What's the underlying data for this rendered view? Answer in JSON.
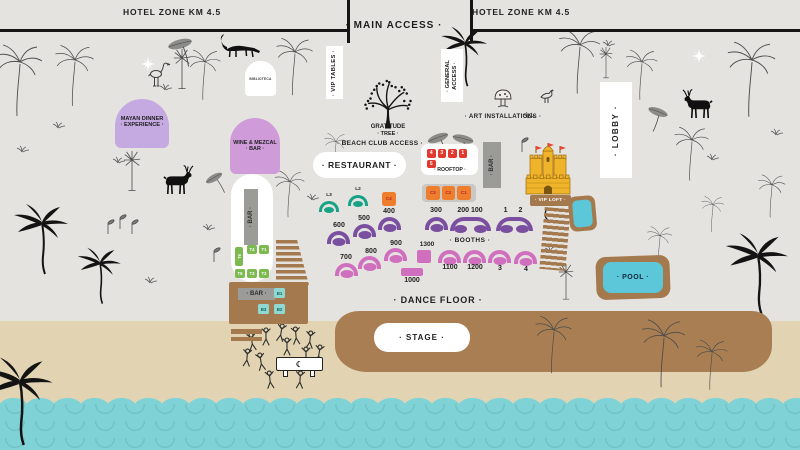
{
  "colors": {
    "background": "#e5e3e0",
    "sand": "#e2d4b2",
    "water": "#7fd2d5",
    "stage_brown": "#a87e52",
    "structure_brown": "#a5794e",
    "purple": "#7b4fa0",
    "pink": "#cf6fbe",
    "teal": "#16a285",
    "table_green": "#7cb94e",
    "cabana_orange": "#ee7e2e",
    "unit_red": "#e2382e",
    "castle_gold": "#f0b42a",
    "lavender": "#c5aae2",
    "orchid": "#cf9cd9",
    "label_gray": "#9b9b98",
    "pool_blue": "#5bc7d8",
    "seat_teal": "#8fd8d2",
    "line_black": "#151515"
  },
  "header": {
    "hotel_zone_left": "HOTEL ZONE KM 4.5",
    "main_access": "· MAIN ACCESS ·",
    "hotel_zone_right": "HOTEL ZONE KM 4.5"
  },
  "access": {
    "vip_tables": "· VIP TABLES ·",
    "general_line1": "· GENERAL",
    "general_line2": "ACCESS ·",
    "beach_club": "· BEACH CLUB ACCESS ·"
  },
  "venues": {
    "mayan_line1": "MAYAN DINNER",
    "mayan_line2": "· EXPERIENCE ·",
    "wine_line1": "WINE & MEZCAL",
    "wine_line2": "· BAR ·",
    "biblioteca": "BIBLIOTECA",
    "gratitude_line1": "GRATITUDE",
    "gratitude_line2": "· TREE ·",
    "restaurant": "· RESTAURANT ·",
    "art_installations": "· ART INSTALLATIONS ·",
    "lobby": "· LOBBY ·",
    "vip_loft": "· VIP LOFT ·",
    "pool": "· POOL ·",
    "dance_floor": "· DANCE FLOOR ·",
    "stage": "· STAGE ·"
  },
  "rooftop": {
    "label": "· ROOFTOP ·",
    "bar": "· BAR ·",
    "units": [
      "4",
      "3",
      "2",
      "1",
      "5"
    ]
  },
  "cabanas": {
    "c3": "C3",
    "c2": "C2",
    "c1": "C1",
    "c4": "C4"
  },
  "lounges": {
    "l3": "L3",
    "l2": "L2"
  },
  "booths": {
    "label": "· BOOTHS ·",
    "purple": {
      "b600": "600",
      "b500": "500",
      "b400": "400",
      "b300": "300",
      "b200_100": "200 100",
      "b1_2": "1 2"
    },
    "pink": {
      "b700": "700",
      "b800": "800",
      "b900": "900",
      "b1300": "1300",
      "b1000": "1000",
      "b1100": "1100",
      "b1200": "1200",
      "b3": "3",
      "b4": "4"
    }
  },
  "bars": {
    "capsule": "· BAR ·",
    "beach": "· BAR ·"
  },
  "tables": {
    "t1": "T1",
    "t2": "T2",
    "t3": "T3",
    "t4": "T4",
    "t5": "T5",
    "t6": "T6",
    "b1": "B1",
    "b2": "B2",
    "b3": "B3"
  },
  "dj_table_moon": "☾"
}
